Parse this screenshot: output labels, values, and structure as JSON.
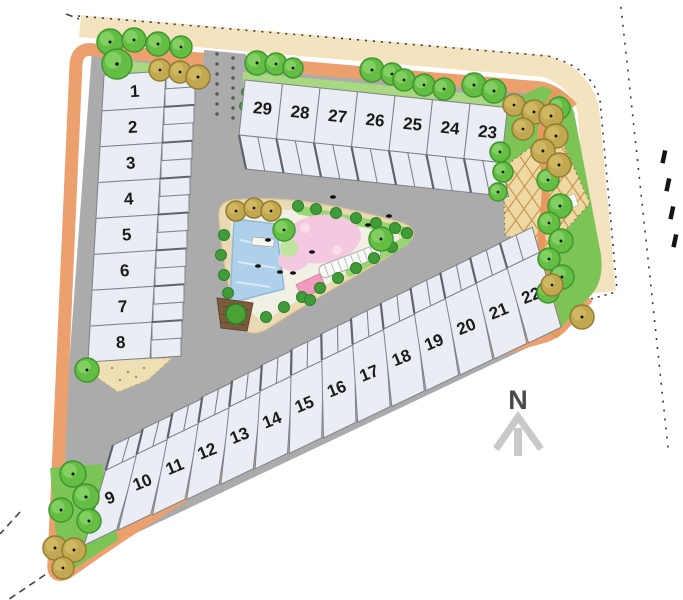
{
  "page_title": "Residential subdivision site plan",
  "north_label": "N",
  "lots": {
    "left_column": [
      "1",
      "2",
      "3",
      "4",
      "5",
      "6",
      "7",
      "8"
    ],
    "top_row": [
      "29",
      "28",
      "27",
      "26",
      "25",
      "24",
      "23"
    ],
    "bottom_row": [
      "9",
      "10",
      "11",
      "12",
      "13",
      "14",
      "15",
      "16",
      "17",
      "18",
      "19",
      "20",
      "21",
      "22"
    ]
  },
  "palette": {
    "road_orange": "#ECA06D",
    "path_orange": "#E8995F",
    "road_grey": "#ABABAB",
    "lot_fill": "#EAEDF3",
    "lot_border": "#7C828C",
    "lot_divider_dark": "#5E646E",
    "grass_strip": "#A8D87F",
    "grass_corner": "#7CC456",
    "hedge_light": "#97D673",
    "shrub_green": "#3F9C38",
    "tree_green": "#64BE43",
    "tree_green_edge": "#3F962F",
    "tree_olive": "#C2A850",
    "tree_olive_edge": "#937D33",
    "pond_blue": "#AFD0EA",
    "pond_edge": "#8FB8D8",
    "blossom_pink": "#F4C9E0",
    "mat_pink": "#F19CBE",
    "adjacent_tan": "#F3E3BE",
    "plaza_sand": "#EFD9A2",
    "plaza_grid": "#C79554",
    "park_sand": "#E9DAB4",
    "park_ground": "#F0F0E4",
    "sand_patch": "#EFDFB4",
    "deck_brown": "#7B5B3B",
    "boundary_dots": "#3A3A3A",
    "north_letter": "#4A4A4A",
    "north_arrow": "#C9C9C9"
  },
  "features": {
    "pond": "pond",
    "blossom_lawn": "blossom lawn",
    "plaza": "paved plaza",
    "park": "central park",
    "deck": "wood deck",
    "bench_walk": "bench walk",
    "north_arrow": "north arrow"
  }
}
